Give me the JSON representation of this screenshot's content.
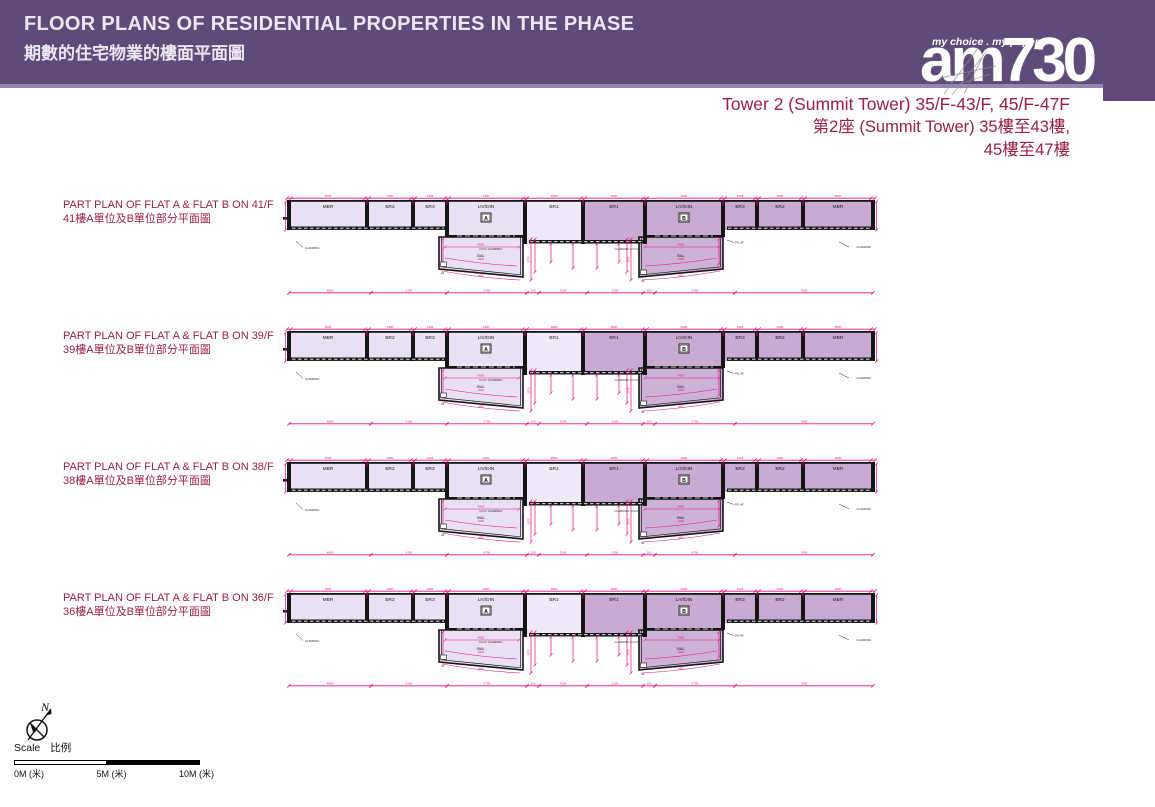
{
  "theme": {
    "purple": "#5e4b79",
    "purple_light": "#9486ae",
    "maroon": "#9b2044",
    "magenta": "#e8117e",
    "ink": "#1a1a1a"
  },
  "header": {
    "title_en": "FLOOR PLANS OF RESIDENTIAL PROPERTIES IN THE PHASE",
    "title_zh": "期數的住宅物業的樓面平面圖"
  },
  "logo": {
    "tagline": "my choice . my paper",
    "brand": "am730"
  },
  "tower_title": {
    "line1": "Tower 2 (Summit Tower) 35/F-43/F, 45/F-47F",
    "line2": "第2座 (Summit Tower) 35樓至43樓,",
    "line3": "45樓至47樓"
  },
  "plans": [
    {
      "floor": "41/F",
      "label_en": "PART PLAN OF FLAT A & FLAT B ON 41/F",
      "label_zh": "41樓A單位及B單位部分平面圖"
    },
    {
      "floor": "39/F",
      "label_en": "PART PLAN OF FLAT A & FLAT B ON 39/F",
      "label_zh": "39樓A單位及B單位部分平面圖"
    },
    {
      "floor": "38/F",
      "label_en": "PART PLAN OF FLAT A & FLAT B ON 38/F",
      "label_zh": "38樓A單位及B單位部分平面圖"
    },
    {
      "floor": "36/F",
      "label_en": "PART PLAN OF FLAT A & FLAT B ON 36/F",
      "label_zh": "36樓A單位及B單位部分平面圖"
    }
  ],
  "compass": {
    "north_label": "N"
  },
  "scale": {
    "title_en": "Scale",
    "title_zh": "比例",
    "tick0": "0M (米)",
    "tick5": "5M (米)",
    "tick10": "10M (米)"
  },
  "plan_drawing": {
    "colors": {
      "light": "#e9e1f3",
      "lighter": "#efe9f7",
      "dark": "#c9aad2",
      "dark2": "#cdb1d6",
      "wall": "#151515",
      "dim": "#e8117e"
    },
    "rooms": [
      {
        "label": "MBR",
        "x": 8,
        "w": 74,
        "h": 29,
        "shade": "light"
      },
      {
        "label": "BR2",
        "x": 86,
        "w": 42,
        "h": 29,
        "shade": "light"
      },
      {
        "label": "BR3",
        "x": 132,
        "w": 30,
        "h": 29,
        "shade": "light"
      },
      {
        "label": "LIV/DIN",
        "x": 166,
        "w": 74,
        "h": 36,
        "shade": "light",
        "unit": "A"
      },
      {
        "label": "BR1",
        "x": 244,
        "w": 54,
        "h": 43,
        "shade": "lighter"
      },
      {
        "label": "BR1",
        "x": 302,
        "w": 58,
        "h": 43,
        "shade": "dark"
      },
      {
        "label": "LIV/DIN",
        "x": 364,
        "w": 74,
        "h": 36,
        "shade": "dark",
        "unit": "B"
      },
      {
        "label": "BR3",
        "x": 442,
        "w": 30,
        "h": 29,
        "shade": "dark"
      },
      {
        "label": "BR2",
        "x": 476,
        "w": 42,
        "h": 29,
        "shade": "dark"
      },
      {
        "label": "MBR",
        "x": 522,
        "w": 66,
        "h": 29,
        "shade": "dark"
      }
    ],
    "top_dims": [
      "3600",
      "2450",
      "1425",
      "4400",
      "2800",
      "2800",
      "4400",
      "1425",
      "2450",
      "3600"
    ],
    "bands": [
      {
        "x1": 8,
        "x2": 162,
        "y": 34.5
      },
      {
        "x1": 444,
        "x2": 588,
        "y": 34.5
      },
      {
        "x1": 246,
        "x2": 360,
        "y": 48
      }
    ],
    "balconies": [
      {
        "x": 156,
        "w": 84,
        "shade": "light",
        "deep": "right",
        "label": "BAL",
        "dim": "4500",
        "arc1": "⌀520",
        "arc2": "⌀801",
        "af": "AF"
      },
      {
        "x": 356,
        "w": 84,
        "shade": "dark2",
        "deep": "left",
        "label": "BAL",
        "dim": "4500",
        "arc1": "⌀520",
        "arc2": "⌀801",
        "af": "AF"
      }
    ],
    "bottom_dims": [
      {
        "x1": 6,
        "x2": 88,
        "label": "4800"
      },
      {
        "x1": 88,
        "x2": 164,
        "label": "6100"
      },
      {
        "x1": 164,
        "x2": 244,
        "label": "4700"
      },
      {
        "x1": 244,
        "x2": 256,
        "label": "200"
      },
      {
        "x1": 256,
        "x2": 304,
        "label": "3100"
      },
      {
        "x1": 304,
        "x2": 360,
        "label": "3100"
      },
      {
        "x1": 360,
        "x2": 372,
        "label": "200"
      },
      {
        "x1": 372,
        "x2": 452,
        "label": "4700"
      },
      {
        "x1": 452,
        "x2": 590,
        "label": "7800"
      }
    ],
    "vdims": [
      {
        "x": 2.5,
        "y1": 10,
        "y2": 38
      },
      {
        "x": 593.5,
        "y1": 10,
        "y2": 38
      },
      {
        "x": 248,
        "y1": 47,
        "y2": 88,
        "label": "2575"
      },
      {
        "x": 252,
        "y1": 47,
        "y2": 80
      },
      {
        "x": 344,
        "y1": 47,
        "y2": 80
      },
      {
        "x": 348,
        "y1": 47,
        "y2": 88,
        "label": "2575"
      },
      {
        "x": 268,
        "y1": 52,
        "y2": 70
      },
      {
        "x": 290,
        "y1": 52,
        "y2": 76
      },
      {
        "x": 314,
        "y1": 52,
        "y2": 76
      },
      {
        "x": 336,
        "y1": 52,
        "y2": 70
      },
      {
        "x": 160,
        "y1": 47,
        "y2": 72
      },
      {
        "x": 436,
        "y1": 47,
        "y2": 72
      }
    ],
    "annotations": [
      {
        "text": "CLADDING",
        "x": 22,
        "y": 57,
        "anchor": "start",
        "leader": [
          20,
          55.5,
          13,
          49
        ]
      },
      {
        "text": "CLADDING",
        "x": 205,
        "y": 58,
        "anchor": "start",
        "leader": [
          204,
          57,
          196,
          57
        ]
      },
      {
        "text": "CLADDING",
        "x": 346,
        "y": 58,
        "anchor": "end",
        "leader": [
          347,
          57,
          356,
          57
        ]
      },
      {
        "text": "CLADDING",
        "x": 588,
        "y": 56,
        "anchor": "end",
        "leader": [
          566,
          55,
          556,
          50
        ]
      },
      {
        "text": "PD, AF",
        "x": 452,
        "y": 51.5,
        "anchor": "start",
        "leader": [
          451,
          50.5,
          444,
          48
        ]
      }
    ]
  }
}
